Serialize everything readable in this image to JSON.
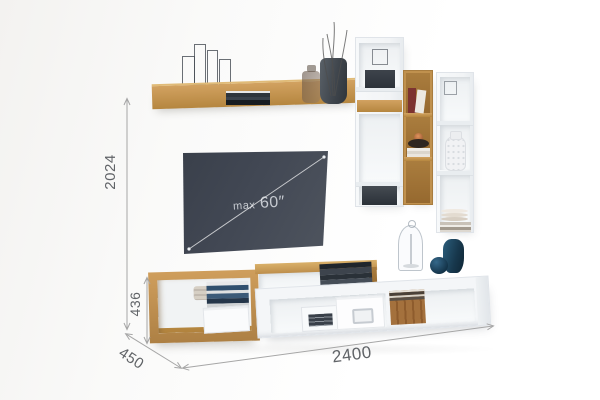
{
  "dimensions": {
    "overall_height": "2024",
    "stand_height": "436",
    "depth": "450",
    "overall_width": "2400"
  },
  "tv": {
    "prefix": "max",
    "size": "60″"
  },
  "colors": {
    "oak_wood": "#c2924f",
    "white_furniture": "#f4f6f8",
    "tv_screen": "#424854",
    "dimension_lines": "#a6a6a6",
    "dimension_text": "#606367",
    "teal_vase": "#1c4a63",
    "background": "#fbfbfa"
  }
}
